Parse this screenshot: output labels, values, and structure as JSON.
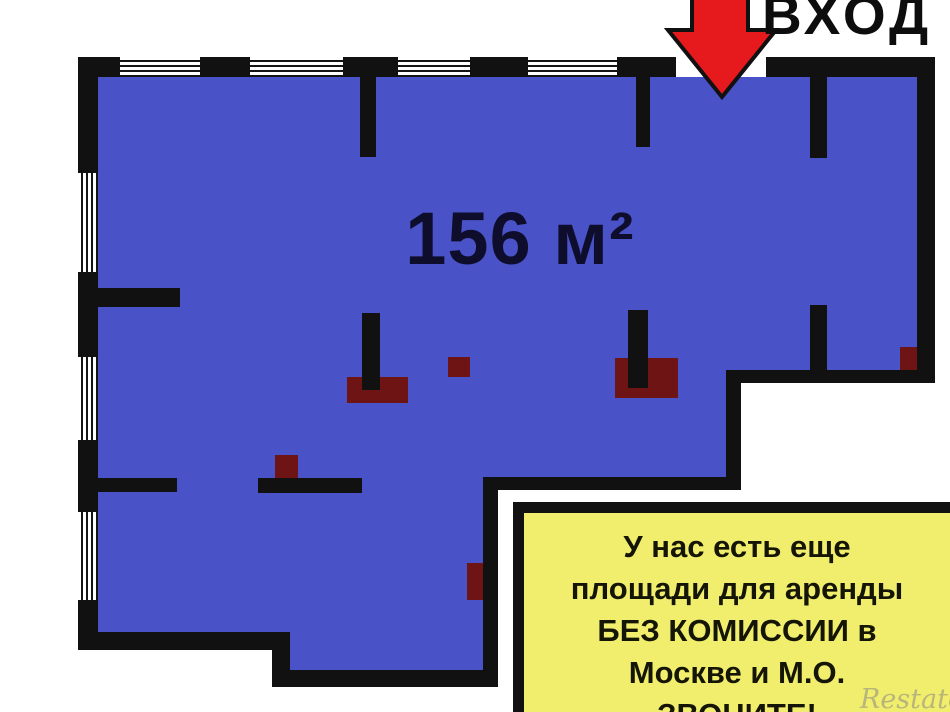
{
  "entrance": {
    "label": "ВХОД"
  },
  "plan": {
    "area_label": "156 м²"
  },
  "info_box": {
    "lines": [
      "У нас есть еще",
      "площади для аренды",
      "БЕЗ КОМИССИИ в",
      "Москве и М.О.",
      "ЗВОНИТЕ!"
    ]
  },
  "watermark": {
    "text": "Restate"
  },
  "icons": {
    "entrance_arrow": "arrow-down-icon"
  },
  "colors": {
    "floor-blue": "#4a52c8",
    "wall-black": "#111111",
    "fixture-red": "#6e1414",
    "arrow-red": "#e6191c",
    "note-yellow": "#f1ee6e"
  }
}
